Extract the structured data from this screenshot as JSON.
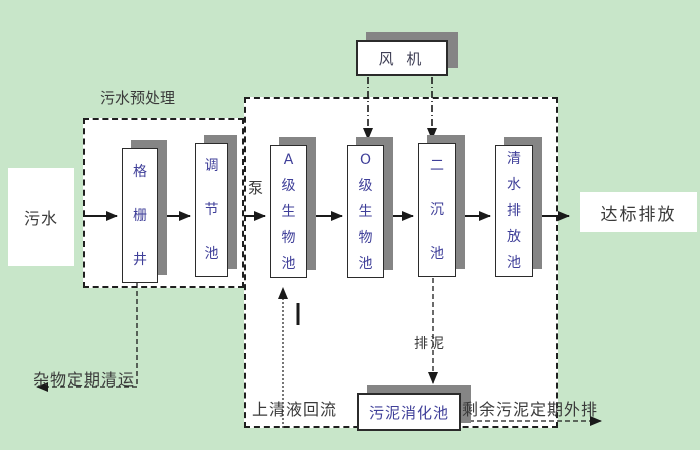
{
  "diagram": {
    "labels": {
      "influent": "污水",
      "pretreatment_section": "污水预处理",
      "grid_well": "格栅井",
      "regulating_tank": "调节池",
      "pump": "泵",
      "blower": "风 机",
      "a_bio_tank": "A级生物池",
      "o_bio_tank": "O级生物池",
      "secondary_sedimentation_tank": "二沉池",
      "clear_water_discharge_tank": "清水排放池",
      "effluent": "达标排放",
      "debris_removal": "杂物定期清运",
      "supernatant_return": "上清液回流",
      "sludge_discharge": "排泥",
      "sludge_digestion_tank": "污泥消化池",
      "excess_sludge_discharge": "剩余污泥定期外排"
    },
    "colors": {
      "background": "#c8e6c9",
      "box_fill": "#ffffff",
      "box_shadow": "#858585",
      "tank_label_text": "#3f3f99",
      "annotation_text": "#3a3a3a",
      "line": "#1a1a1a"
    }
  }
}
